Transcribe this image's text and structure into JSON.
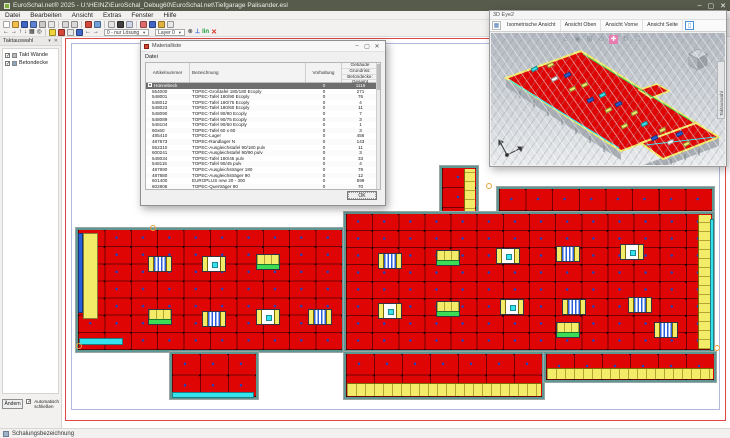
{
  "window": {
    "title": "EuroSchal.net® 2025 - U:\\HEINZ\\EuroSchal_Debug60\\EuroSchal.net\\Tiefgarage Palisander.esl",
    "controls": {
      "minimize": "–",
      "maximize": "▢",
      "close": "✕"
    }
  },
  "menubar": {
    "items": [
      "Datei",
      "Bearbeiten",
      "Ansicht",
      "Extras",
      "Fenster",
      "Hilfe"
    ]
  },
  "toolbars": {
    "row1_icons": [
      {
        "name": "new-file-icon",
        "c": "#fdfdfd"
      },
      {
        "name": "open-folder-icon",
        "c": "#f0c04a"
      },
      {
        "name": "save-icon",
        "c": "#3f66c4"
      },
      {
        "name": "save-all-icon",
        "c": "#5d7fd0"
      },
      {
        "name": "print-icon",
        "c": "#c9c9c9"
      },
      {
        "name": "print-preview-icon",
        "c": "#e8e8e8"
      },
      {
        "name": "sep"
      },
      {
        "name": "undo-icon",
        "c": "#d8d8d8"
      },
      {
        "name": "redo-icon",
        "c": "#d8d8d8"
      },
      {
        "name": "sep"
      },
      {
        "name": "paint-icon",
        "c": "#d2483a"
      },
      {
        "name": "render-icon",
        "c": "#6f9fd8"
      },
      {
        "name": "sep"
      },
      {
        "name": "measure-icon",
        "c": "#e5e5e5"
      },
      {
        "name": "cursor-icon",
        "c": "#404040"
      },
      {
        "name": "grid-icon",
        "c": "#cfd8ea"
      },
      {
        "name": "sep"
      },
      {
        "name": "add-element-icon",
        "c": "#e06a6a"
      },
      {
        "name": "panel-blue-icon",
        "c": "#3f66c4"
      },
      {
        "name": "panel-color-icon",
        "c": "#e0b13f"
      },
      {
        "name": "zoom-tool-icon",
        "c": "#e8e8e8"
      }
    ],
    "row2": {
      "left_glyphs": [
        {
          "name": "move-left-icon",
          "g": "←"
        },
        {
          "name": "move-right-icon",
          "g": "→"
        },
        {
          "name": "move-up-icon",
          "g": "↑"
        },
        {
          "name": "move-down-icon",
          "g": "↓"
        },
        {
          "name": "raster-icon",
          "g": "▦"
        },
        {
          "name": "magnifier-icon",
          "g": "◎"
        }
      ],
      "group_icons": [
        {
          "name": "takt-yellow-icon",
          "c": "#f0d43c"
        },
        {
          "name": "takt-red-icon",
          "c": "#d2483a"
        },
        {
          "name": "list-view-icon",
          "c": "#e8e8e8"
        },
        {
          "name": "cube-view-icon",
          "c": "#3f66c4"
        }
      ],
      "nav_glyphs": [
        {
          "name": "prev-solution-icon",
          "g": "←"
        },
        {
          "name": "next-solution-icon",
          "g": "→"
        }
      ],
      "solution_select": "0 - nur Lösung",
      "layer_select": "Layer 0",
      "link_icon_glyph": "⊗",
      "ortho_label": "⊥",
      "lin_label": "lin",
      "close_label": "✕"
    }
  },
  "sidebar": {
    "title": "Taktauswahl",
    "pin_glyph": "▾",
    "close_glyph": "✕",
    "items": [
      {
        "label": "Takt Wände",
        "checked": "✓",
        "icon": "wall"
      },
      {
        "label": "Betondecke",
        "checked": "✓",
        "icon": "slab"
      }
    ],
    "change_button": "Ändern",
    "auto_checkbox_checked": "✓",
    "auto_label_line1": "Automatisch",
    "auto_label_line2": "schließen"
  },
  "statusbar": {
    "text": "Schalungsbezeichnung"
  },
  "dialog": {
    "title": "Materialliste",
    "menu": "Datei",
    "ok_button": "OK",
    "table": {
      "headers": {
        "col1": "Artikelnummer",
        "col2": "Bezeichnung",
        "col3": "Vorhaltung",
        "col4_lines": [
          "Gebäude",
          "Grundriss:",
          "Betondecke:",
          "Gesamt"
        ]
      },
      "group_row": {
        "expander": "−",
        "label": "Hünnebeck",
        "vorhaltung": "0",
        "gesamt": "1116"
      },
      "rows": [
        [
          "554000",
          "TOPEC-Großtafel 180/180 Ecoply",
          "0",
          "271"
        ],
        [
          "548001",
          "TOPEC-Tafel 180/90 Ecoply",
          "0",
          "76"
        ],
        [
          "548012",
          "TOPEC-Tafel 180/75 Ecoply",
          "0",
          "4"
        ],
        [
          "548023",
          "TOPEC-Tafel 180/60 Ecoply",
          "0",
          "11"
        ],
        [
          "548090",
          "TOPEC-Tafel 90/90 Ecoply",
          "0",
          "7"
        ],
        [
          "548089",
          "TOPEC-Tafel 90/75 Ecoply",
          "0",
          "3"
        ],
        [
          "548104",
          "TOPEC-Tafel 90/60 Ecoply",
          "0",
          "1"
        ],
        [
          "60x60",
          "TOPEC-Tafel 60 x 60",
          "0",
          "3"
        ],
        [
          "485410",
          "TOPEC-Lager",
          "0",
          "456"
        ],
        [
          "487873",
          "TOPEC-Randlager N",
          "0",
          "143"
        ],
        [
          "552310",
          "TOPEC-Ausgleichstafel 90/180 pulv",
          "0",
          "11"
        ],
        [
          "600241",
          "TOPEC-Ausgleichstafel 90/90 pulv",
          "0",
          "3"
        ],
        [
          "548034",
          "TOPEC-Tafel 180/45 pulv",
          "0",
          "33"
        ],
        [
          "548115",
          "TOPEC-Tafel 90/45 pulv",
          "0",
          "4"
        ],
        [
          "487890",
          "TOPEC-Ausgleichsträger 180",
          "0",
          "79"
        ],
        [
          "487880",
          "TOPEC-Ausgleichsträger 90",
          "0",
          "12"
        ],
        [
          "601400",
          "EUROPLUS new 20 - 300",
          "0",
          "599"
        ],
        [
          "602806",
          "TOPEC-Querträger 90",
          "0",
          "70"
        ]
      ]
    }
  },
  "viewer3d": {
    "title": "3D Eye2",
    "toolbar_buttons": [
      "Isometrische Ansicht",
      "Ansicht Oben",
      "Ansicht Vorne",
      "Ansicht Seite"
    ],
    "overlay_icons": [
      {
        "name": "home-view-icon",
        "g": "⌂"
      },
      {
        "name": "orbit-icon",
        "g": "◉"
      },
      {
        "name": "zoom-window-icon",
        "g": "⊞"
      },
      {
        "name": "zoom-icon",
        "g": "⊙"
      },
      {
        "name": "pan-icon",
        "g": "✚",
        "hot": true
      },
      {
        "name": "rotate-icon",
        "g": "↻"
      },
      {
        "name": "fit-view-icon",
        "g": "⛶"
      }
    ],
    "side_tab": "Taktauswahl",
    "patches": [
      {
        "x": 56,
        "y": 30,
        "c": "#f3ec69"
      },
      {
        "x": 73,
        "y": 40,
        "c": "#2b5fd9"
      },
      {
        "x": 90,
        "y": 50,
        "c": "#f3ec69"
      },
      {
        "x": 108,
        "y": 60,
        "c": "#35e3ee"
      },
      {
        "x": 124,
        "y": 69,
        "c": "#2b5fd9"
      },
      {
        "x": 140,
        "y": 78,
        "c": "#f3ec69"
      },
      {
        "x": 60,
        "y": 44,
        "c": "#ffffff"
      },
      {
        "x": 78,
        "y": 54,
        "c": "#f3ec69"
      },
      {
        "x": 96,
        "y": 65,
        "c": "#2b5fd9"
      },
      {
        "x": 114,
        "y": 75,
        "c": "#f3ec69"
      },
      {
        "x": 150,
        "y": 89,
        "c": "#35e3ee"
      },
      {
        "x": 168,
        "y": 95,
        "c": "#f3ec69"
      },
      {
        "x": 185,
        "y": 99,
        "c": "#2b5fd9"
      },
      {
        "x": 176,
        "y": 107,
        "c": "#ffffff"
      },
      {
        "x": 192,
        "y": 109,
        "c": "#f3ec69"
      },
      {
        "x": 160,
        "y": 103,
        "c": "#2b5fd9"
      },
      {
        "x": 40,
        "y": 34,
        "c": "#35e3ee"
      },
      {
        "x": 130,
        "y": 91,
        "c": "#f3ec69"
      }
    ]
  },
  "plan": {
    "colors": {
      "panel": "#e00505",
      "gridline": "rgba(40,0,0,0.6)",
      "wall": "#5e9692",
      "yellow": "#f3ec69",
      "cyan": "#35e3ee",
      "green": "#3ddc55",
      "blue": "#2b5fd9",
      "dot": "#1a46c8"
    },
    "regions": [
      {
        "name": "deck-top-strip",
        "x": 435,
        "y": 150,
        "w": 217,
        "h": 26,
        "cols": 8,
        "rows": 1
      },
      {
        "name": "deck-small-block",
        "x": 378,
        "y": 129,
        "w": 38,
        "h": 64,
        "cols": 1,
        "rows": 3,
        "yr": 11
      },
      {
        "name": "deck-left-block",
        "x": 14,
        "y": 191,
        "w": 268,
        "h": 124,
        "cols": 10,
        "rows": 7
      },
      {
        "name": "deck-right-block",
        "x": 282,
        "y": 175,
        "w": 370,
        "h": 140,
        "cols": 14,
        "rows": 8,
        "yr": 13
      },
      {
        "name": "deck-lower-left-ext",
        "x": 282,
        "y": 315,
        "w": 200,
        "h": 47,
        "cols": 7,
        "rows": 2,
        "yb": 13
      },
      {
        "name": "deck-lower-right-ext",
        "x": 482,
        "y": 315,
        "w": 172,
        "h": 30,
        "cols": 6,
        "rows": 1,
        "yb": 11
      },
      {
        "name": "deck-bottom-block",
        "x": 108,
        "y": 315,
        "w": 88,
        "h": 47,
        "cols": 3,
        "rows": 2
      }
    ],
    "decos": [
      {
        "x": 16,
        "y": 196,
        "w": 5,
        "h": 80,
        "c": "#2b5fd9"
      },
      {
        "x": 21,
        "y": 196,
        "w": 15,
        "h": 86,
        "c": "#f3ec69"
      },
      {
        "x": 17,
        "y": 301,
        "w": 44,
        "h": 7,
        "c": "#35e3ee"
      },
      {
        "x": 110,
        "y": 355,
        "w": 82,
        "h": 6,
        "c": "#35e3ee"
      },
      {
        "x": 648,
        "y": 182,
        "w": 4,
        "h": 132,
        "c": "#35e3ee"
      }
    ],
    "features": [
      {
        "x": 86,
        "y": 219,
        "k": "stripe"
      },
      {
        "x": 140,
        "y": 219,
        "k": "shaft"
      },
      {
        "x": 194,
        "y": 217,
        "k": "green"
      },
      {
        "x": 86,
        "y": 272,
        "k": "green"
      },
      {
        "x": 140,
        "y": 274,
        "k": "stripe"
      },
      {
        "x": 194,
        "y": 272,
        "k": "shaft"
      },
      {
        "x": 246,
        "y": 272,
        "k": "stripe"
      },
      {
        "x": 316,
        "y": 216,
        "k": "stripe"
      },
      {
        "x": 374,
        "y": 213,
        "k": "green"
      },
      {
        "x": 434,
        "y": 211,
        "k": "shaft"
      },
      {
        "x": 494,
        "y": 209,
        "k": "stripe"
      },
      {
        "x": 558,
        "y": 207,
        "k": "shaft"
      },
      {
        "x": 316,
        "y": 266,
        "k": "shaft"
      },
      {
        "x": 374,
        "y": 264,
        "k": "green"
      },
      {
        "x": 438,
        "y": 262,
        "k": "shaft"
      },
      {
        "x": 500,
        "y": 262,
        "k": "stripe"
      },
      {
        "x": 566,
        "y": 260,
        "k": "stripe"
      },
      {
        "x": 494,
        "y": 285,
        "k": "green"
      },
      {
        "x": 592,
        "y": 285,
        "k": "stripe"
      }
    ],
    "handles": [
      {
        "x": 88,
        "y": 188
      },
      {
        "x": 14,
        "y": 306
      },
      {
        "x": 424,
        "y": 146
      },
      {
        "x": 652,
        "y": 308
      }
    ]
  }
}
